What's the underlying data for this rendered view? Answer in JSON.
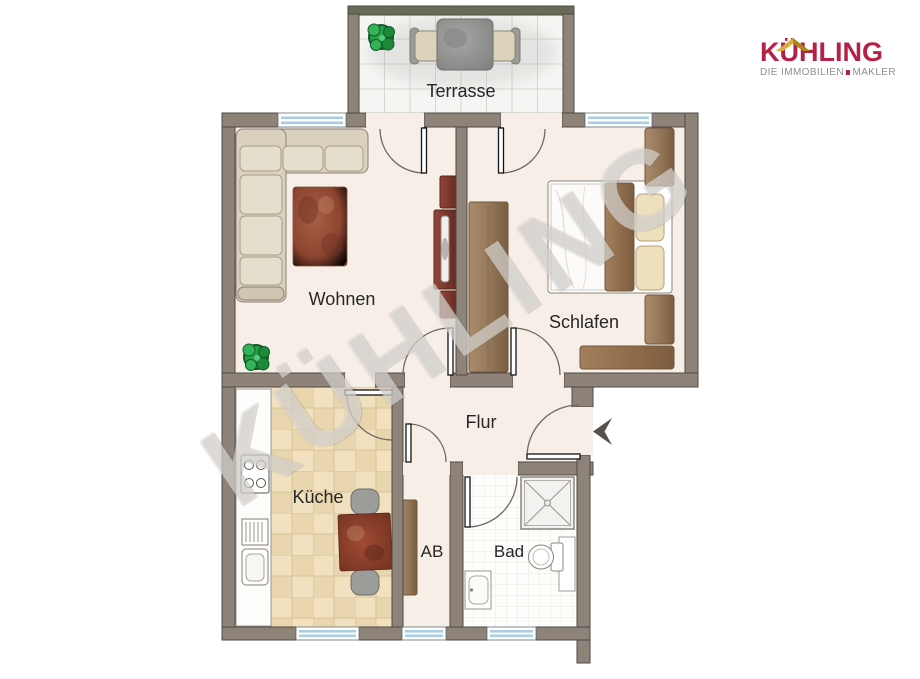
{
  "page": {
    "background": "#ffffff"
  },
  "logo": {
    "brand": "KÜHLING",
    "tagline_left": "DIE IMMOBILIEN",
    "tagline_right": "MAKLER",
    "brand_color": "#b52146",
    "tagline_color": "#8f8f8f",
    "roof_color": "#d9ae3c",
    "roof_shadow_color": "#ab851f"
  },
  "watermark": {
    "text": "KÜHLING"
  },
  "plan": {
    "rooms": {
      "terrasse": "Terrasse",
      "wohnen": "Wohnen",
      "schlafen": "Schlafen",
      "flur": "Flur",
      "kueche": "Küche",
      "ab": "AB",
      "bad": "Bad"
    },
    "colors": {
      "wall": "#8d8378",
      "wall_outline": "#4f4a43",
      "terrace_wall_top": "#676b58",
      "floor": "#f7efe7",
      "kitchen_tile": "#f1e1bf",
      "bath_tile": "#fdfdfc",
      "terrace_tile": "#f5f5f3",
      "window_glass": "#a9cde4",
      "door_leaf": "#141414",
      "door_arc": "#6f6960",
      "plant": "#28a047",
      "entry_arrow": "#56524a",
      "label_text": "#262626"
    }
  }
}
